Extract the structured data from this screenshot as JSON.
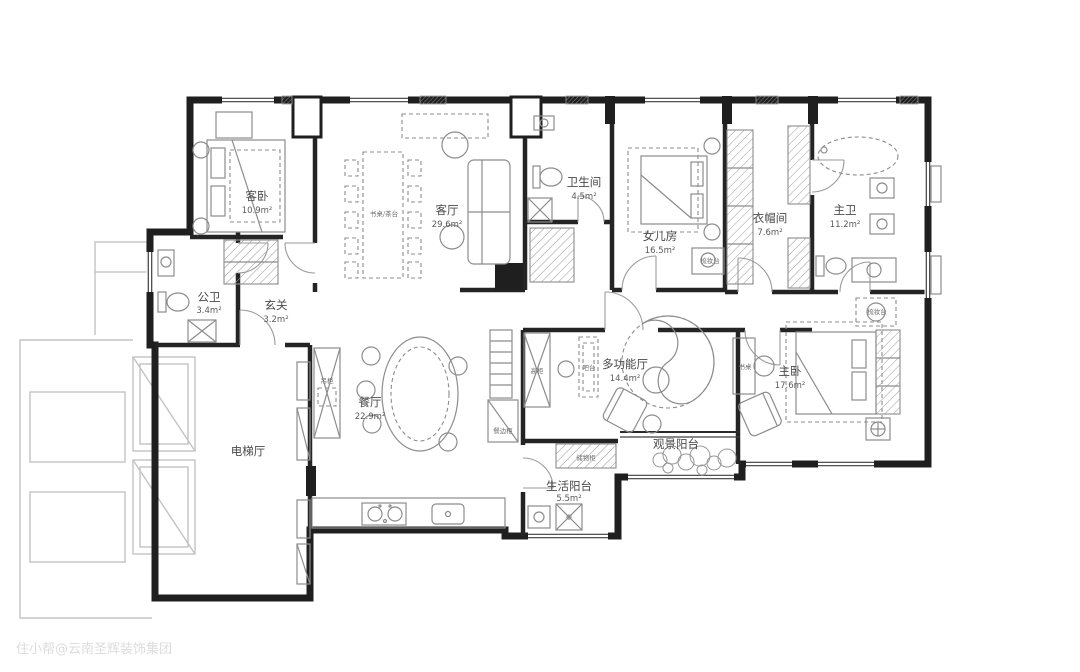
{
  "watermark": "住小帮@云南圣辉装饰集团",
  "plan": {
    "rooms": {
      "guest_bedroom": {
        "name": "客卧",
        "area": "10.9m²"
      },
      "living_room": {
        "name": "客厅",
        "area": "29.6m²"
      },
      "bathroom": {
        "name": "卫生间",
        "area": "4.5m²"
      },
      "daughter_room": {
        "name": "女儿房",
        "area": "16.5m²"
      },
      "cloakroom": {
        "name": "衣帽间",
        "area": "7.6m²"
      },
      "master_bathroom": {
        "name": "主卫",
        "area": "11.2m²"
      },
      "guest_toilet": {
        "name": "公卫",
        "area": "3.4m²"
      },
      "entryway": {
        "name": "玄关",
        "area": "3.2m²"
      },
      "dining_room": {
        "name": "餐厅",
        "area": "22.9m²"
      },
      "elevator_hall": {
        "name": "电梯厅"
      },
      "multifunction_room": {
        "name": "多功能厅",
        "area": "14.4m²"
      },
      "view_balcony": {
        "name": "观景阳台"
      },
      "service_balcony": {
        "name": "生活阳台",
        "area": "5.5m²"
      },
      "master_bedroom": {
        "name": "主卧",
        "area": "17.6m²"
      }
    },
    "fixtures": {
      "desk_tea_table": "书桌/茶台",
      "dresser_daughter": "梳妆台",
      "dresser_master": "梳妆台",
      "desk_master": "书桌",
      "bar_table": "吧台",
      "tall_cabinet": "高柜",
      "hanging_cabinet": "吊柜",
      "sideboard": "餐边柜",
      "storage_cabinet": "储物柜"
    }
  }
}
